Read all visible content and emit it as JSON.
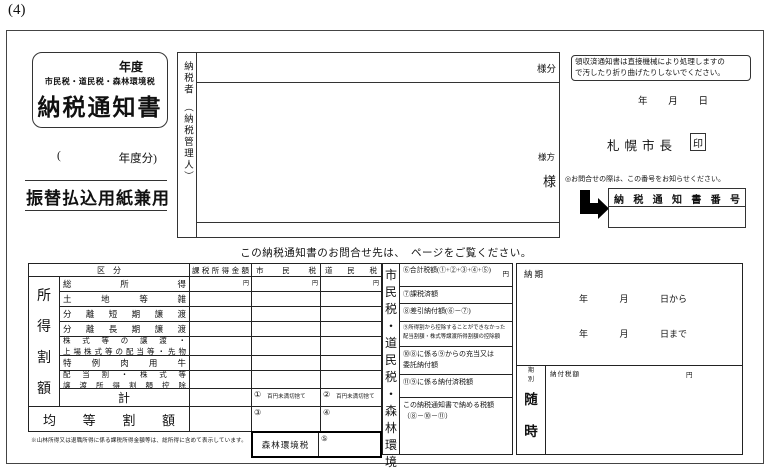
{
  "page_label": "(4)",
  "header": {
    "title_box": {
      "fiscal_year": "年度",
      "subtitle": "市民税・道民税・森林環境税",
      "title": "納税通知書"
    },
    "fiscal_year_line": {
      "open": "(",
      "suffix": "年度分)"
    },
    "transfer_label": "振替払込用紙兼用",
    "taxpayer_label": "納税者　（納税管理人）",
    "sama_bun": "様分",
    "sama_kata": "様方",
    "sama": "様"
  },
  "notice_area": {
    "machine_note_line1": "領収済通知書は直接機械により処理しますの",
    "machine_note_line2": "で汚したり折り曲げたりしないでください。",
    "date": {
      "year": "年",
      "month": "月",
      "day": "日"
    },
    "mayor": "札幌市長",
    "seal": "印",
    "inquiry_note": "◎お問合せの際は、この番号をお知らせください。",
    "number_box_label": "納税通知書番号"
  },
  "contact_note": "この納税通知書のお問合せ先は、　ページをご覧ください。",
  "table": {
    "headers": {
      "kubun": "区　分",
      "taxable_income": "課税所得金額",
      "city_tax": "市民税",
      "pref_tax": "道民税"
    },
    "yen": "円",
    "income_group_label": "所得割額",
    "rows": [
      "総所得",
      "土地等雑",
      "分離短期譲渡",
      "分離長期譲渡",
      "株式等の譲渡・\n上場株式等の配当等・先物",
      "特例肉用牛",
      "配当割・株式等\n譲渡所得割額控除"
    ],
    "total_row": {
      "label": "計",
      "city_mark": "①",
      "pref_mark": "②",
      "rounding_note": "百円未満切捨て"
    },
    "per_capita_row": {
      "label": "均等割額",
      "city_mark": "③",
      "pref_mark": "④"
    },
    "vertical_strip": "市民税・道民税・森林環境税",
    "forest_box": {
      "label": "森林環境税",
      "mark": "⑤"
    },
    "footnote": "※山林所得又は退職所得に係る課税所得金額等は、総所得に含めて表示しています。",
    "summary_rows": [
      "⑥合計税額(①+②+③+④+⑤)",
      "⑦課税済額",
      "⑧差引納付額(⑥－⑦)",
      "⑨所得割から控除することができなかった\n配当割額・株式等譲渡所得割額の控除額",
      "⑩⑧に係る⑨からの充当又は\n委託納付額",
      "⑪⑨に係る納付済税額",
      "この納税通知書で納める税額\n（⑧－⑩－⑪）"
    ],
    "summary_yen": "円"
  },
  "payment": {
    "noki_label": "納期",
    "from": {
      "year": "年",
      "month": "月",
      "day": "日から"
    },
    "to": {
      "year": "年",
      "month": "月",
      "day": "日まで"
    },
    "kibetsu_label": "期別",
    "amount_label": "納付税額",
    "yen": "円",
    "zuiji": "随時"
  }
}
